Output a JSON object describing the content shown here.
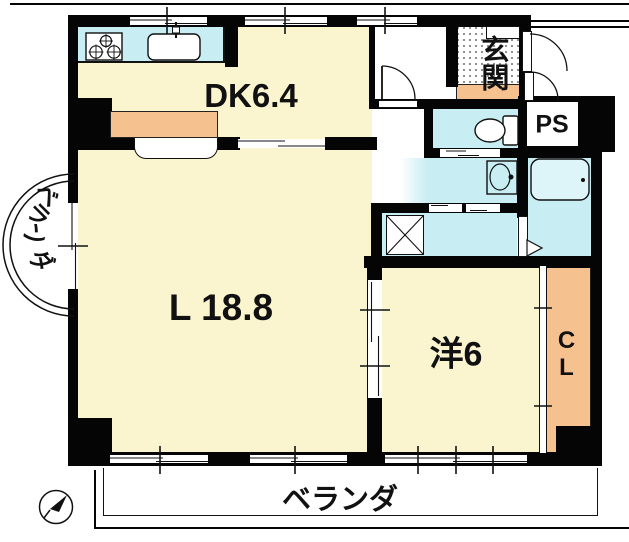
{
  "floorplan": {
    "rooms": {
      "dining_kitchen": {
        "label": "DK6.4"
      },
      "living": {
        "label": "L 18.8"
      },
      "western_room": {
        "label": "洋6"
      },
      "entrance": {
        "label": "玄関"
      },
      "pipe_space": {
        "label": "PS"
      },
      "closet": {
        "label": "CL"
      },
      "balcony_left": {
        "label": "ベランダ"
      },
      "balcony_bottom": {
        "label": "ベランダ"
      }
    },
    "colors": {
      "room_fill": "#faf5cf",
      "wet_area_fill": "#c8edf3",
      "accent_orange": "#f5c18e",
      "wall": "#050505"
    }
  }
}
